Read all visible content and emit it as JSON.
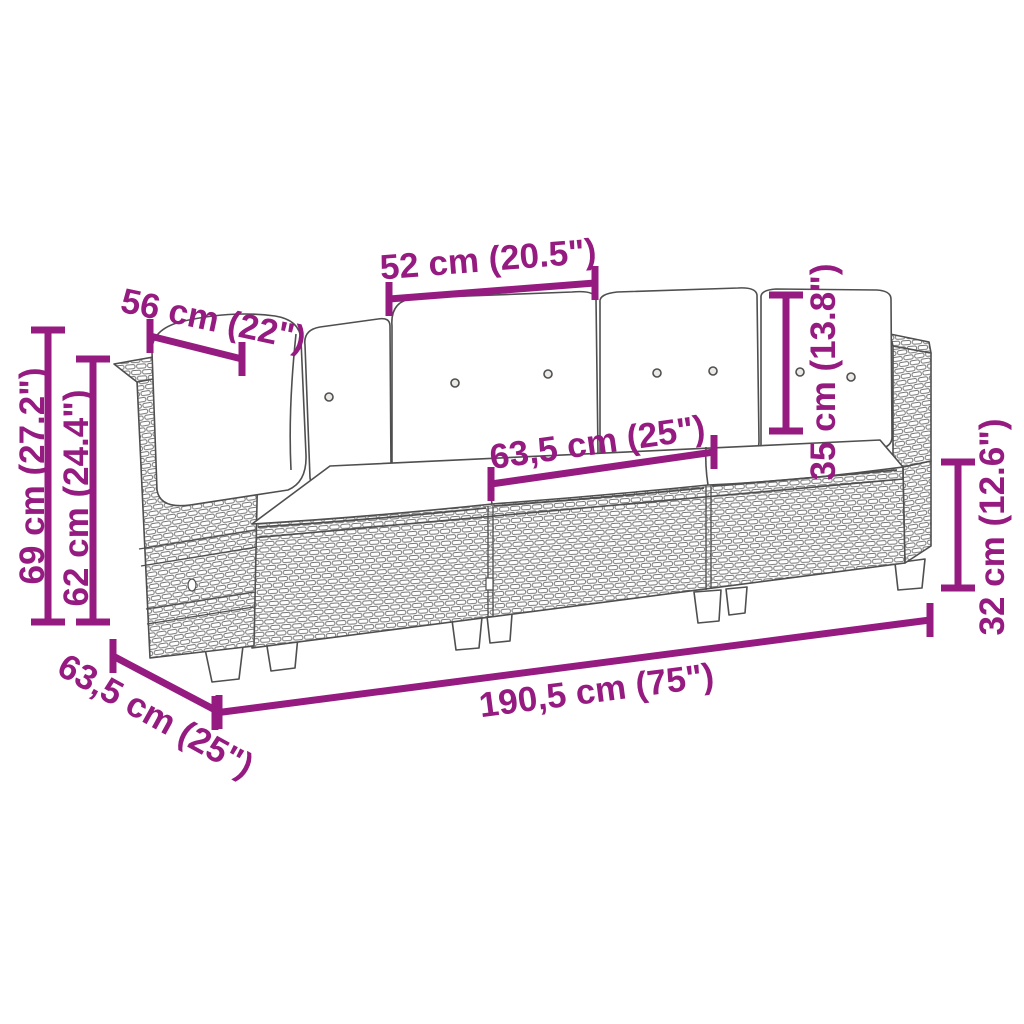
{
  "canvas": {
    "width": 1024,
    "height": 1024,
    "background": "#ffffff"
  },
  "style": {
    "accent_color": "#951b81",
    "outline_color": "#4f4f4f",
    "wicker_stroke": "#767676",
    "cushion_fill": "#ffffff",
    "dimension_line_width": 7,
    "tick_half_length": 17,
    "label_font_size": 35
  },
  "figure": {
    "type": "product-dimension-diagram",
    "subject": "3-seater rattan garden sofa with back and seat cushions",
    "view": "perspective line drawing",
    "back_cushion_count": 4,
    "seat_section_count": 3
  },
  "dimensions": [
    {
      "id": "backrest-cushion-width",
      "label": "52 cm (20.5\")",
      "value_cm": 52,
      "value_in": 20.5,
      "line": [
        389,
        299,
        595,
        283
      ],
      "tick": "v",
      "label_pos": [
        489,
        271
      ],
      "label_angle": -4.5
    },
    {
      "id": "armrest-depth",
      "label": "56 cm (22\")",
      "value_cm": 56,
      "value_in": 22,
      "line": [
        150,
        336,
        242,
        359
      ],
      "tick": "v",
      "label_pos": [
        211,
        331
      ],
      "label_angle": 12
    },
    {
      "id": "total-height",
      "label": "69 cm (27.2\")",
      "value_cm": 69,
      "value_in": 27.2,
      "line": [
        48,
        330,
        48,
        622
      ],
      "tick": "h",
      "label_pos": [
        44,
        476
      ],
      "label_angle": -90
    },
    {
      "id": "armrest-height",
      "label": "62 cm (24.4\")",
      "value_cm": 62,
      "value_in": 24.4,
      "line": [
        93,
        359,
        93,
        622
      ],
      "tick": "h",
      "label_pos": [
        88,
        498
      ],
      "label_angle": -90
    },
    {
      "id": "back-cushion-height",
      "label": "35 cm (13.8\")",
      "value_cm": 35,
      "value_in": 13.8,
      "line": [
        786,
        295,
        786,
        431
      ],
      "tick": "h",
      "label_pos": [
        835,
        372
      ],
      "label_angle": -90
    },
    {
      "id": "seat-depth",
      "label": "63,5 cm (25\")",
      "value_cm": 63.5,
      "value_in": 25,
      "line": [
        491,
        484,
        714,
        452
      ],
      "tick": "v",
      "label_pos": [
        599,
        454
      ],
      "label_angle": -8
    },
    {
      "id": "frame-height",
      "label": "32 cm (12.6\")",
      "value_cm": 32,
      "value_in": 12.6,
      "line": [
        958,
        462,
        958,
        588
      ],
      "tick": "h",
      "label_pos": [
        1004,
        527
      ],
      "label_angle": -90
    },
    {
      "id": "total-width",
      "label": "190,5 cm (75\")",
      "value_cm": 190.5,
      "value_in": 75,
      "line": [
        215,
        713,
        930,
        620
      ],
      "tick": "v",
      "label_pos": [
        598,
        702
      ],
      "label_angle": -7.4
    },
    {
      "id": "total-depth",
      "label": "63,5 cm (25\")",
      "value_cm": 63.5,
      "value_in": 25,
      "line": [
        113,
        656,
        219,
        712
      ],
      "tick": "v",
      "label_pos": [
        150,
        726
      ],
      "label_angle": 29
    }
  ]
}
